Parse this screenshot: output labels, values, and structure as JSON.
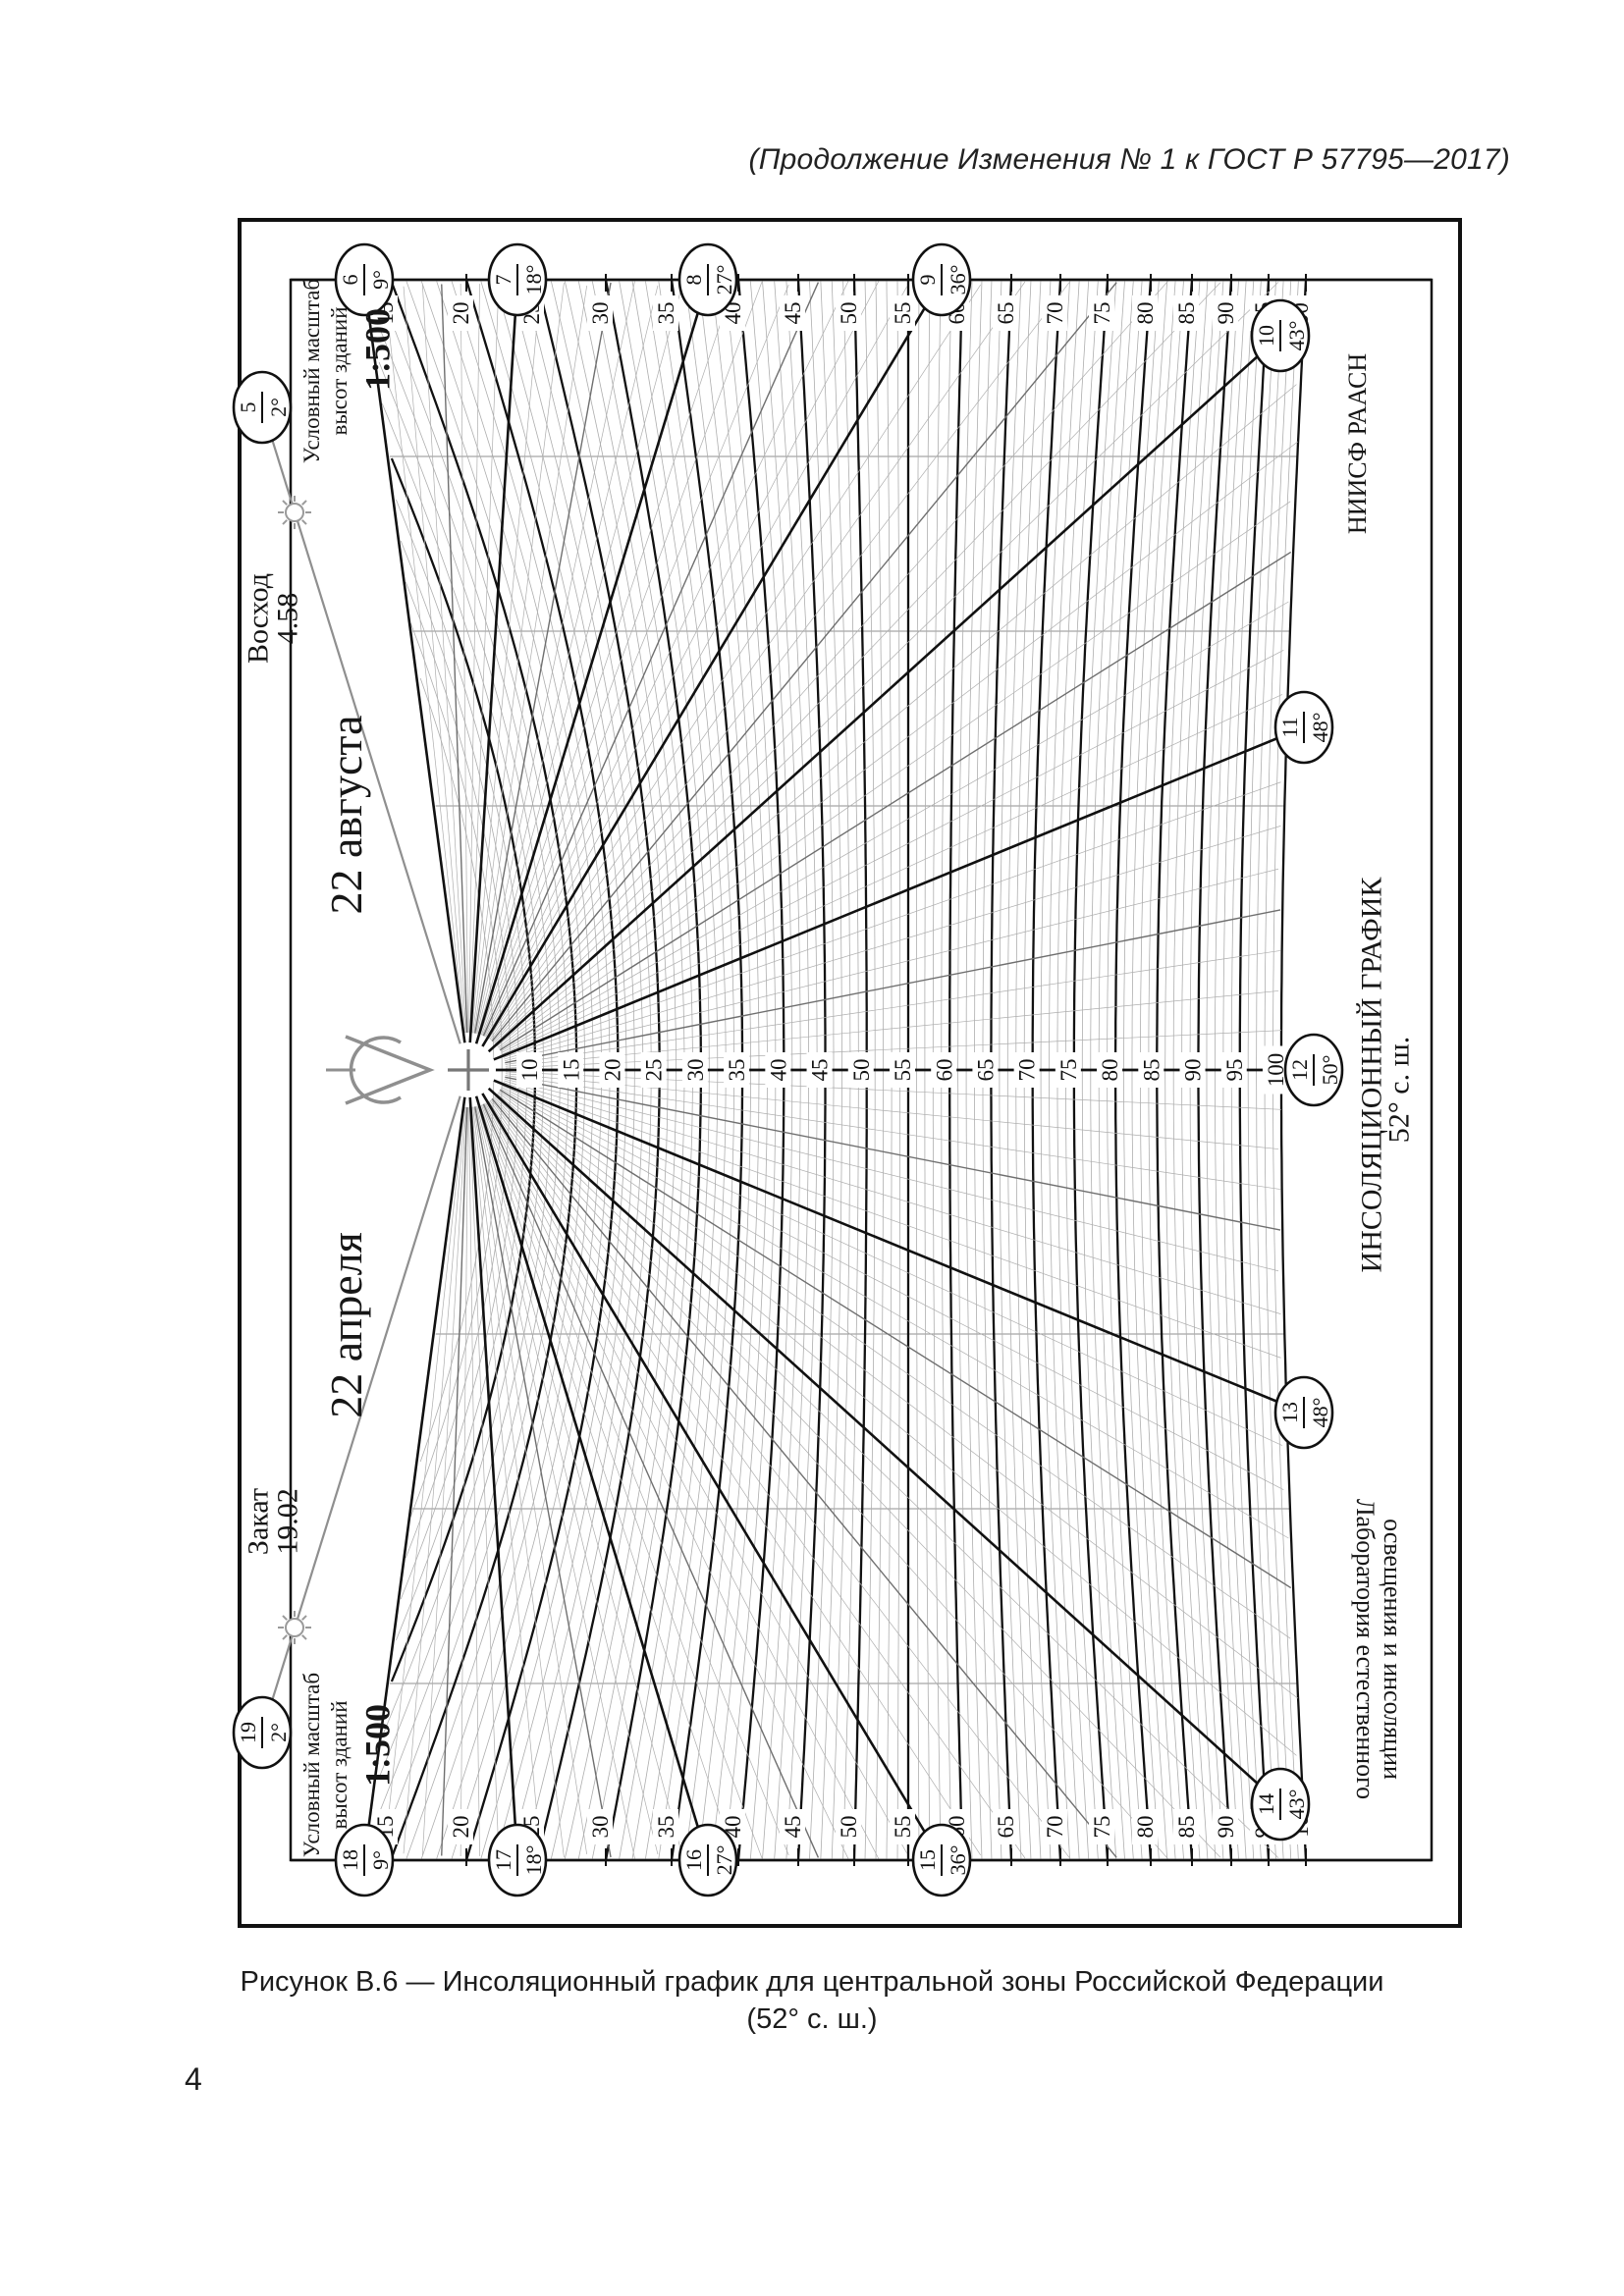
{
  "page": {
    "header": "(Продолжение Изменения № 1 к ГОСТ Р 57795—2017)",
    "number": "4"
  },
  "caption": {
    "line1": "Рисунок В.6 — Инсоляционный график для центральной зоны Российской Федерации",
    "line2": "(52° с. ш.)"
  },
  "chart_data": {
    "type": "diagram",
    "title": "ИНСОЛЯЦИОННЫЙ ГРАФИК",
    "latitude_label": "52° с. ш.",
    "organization": "НИИСФ РААСН",
    "laboratory": [
      "Лаборатория естественного",
      "освещения и инсоляции"
    ],
    "sunrise": {
      "label": "Восход",
      "time": "4.58"
    },
    "sunset": {
      "label": "Закат",
      "time": "19.02"
    },
    "date_august": "22 августа",
    "date_april": "22 апреля",
    "scale_note": {
      "line1": "Условный масштаб",
      "line2": "высот зданий",
      "ratio": "1:500"
    },
    "hours": [
      {
        "hour": "5",
        "altitude": "2°",
        "azimuth": 109.0
      },
      {
        "hour": "6",
        "altitude": "9°",
        "azimuth": 97.5
      },
      {
        "hour": "7",
        "altitude": "18°",
        "azimuth": 86.4
      },
      {
        "hour": "8",
        "altitude": "27°",
        "azimuth": 73.1
      },
      {
        "hour": "9",
        "altitude": "36°",
        "azimuth": 59.0
      },
      {
        "hour": "10",
        "altitude": "43°",
        "azimuth": 42.1
      },
      {
        "hour": "11",
        "altitude": "48°",
        "azimuth": 22.3
      },
      {
        "hour": "12",
        "altitude": "50°",
        "azimuth": 0.0
      },
      {
        "hour": "13",
        "altitude": "48°",
        "azimuth": -22.3
      },
      {
        "hour": "14",
        "altitude": "43°",
        "azimuth": -42.1
      },
      {
        "hour": "15",
        "altitude": "36°",
        "azimuth": -59.0
      },
      {
        "hour": "16",
        "altitude": "27°",
        "azimuth": -73.1
      },
      {
        "hour": "17",
        "altitude": "18°",
        "azimuth": -86.4
      },
      {
        "hour": "18",
        "altitude": "9°",
        "azimuth": -97.5
      },
      {
        "hour": "19",
        "altitude": "2°",
        "azimuth": -109.0
      }
    ],
    "center_scale": [
      10,
      15,
      20,
      25,
      30,
      35,
      40,
      45,
      50,
      55,
      60,
      65,
      70,
      75,
      80,
      85,
      90,
      95,
      100
    ],
    "edge_scale": [
      15,
      20,
      25,
      30,
      35,
      40,
      45,
      50,
      55,
      60,
      65,
      70,
      75,
      80,
      85,
      90,
      95,
      100
    ],
    "colors": {
      "ink": "#111111",
      "gray_line": "#8f8f8f",
      "mesh": "#aeaeae",
      "half_hour": "#6f6f6f"
    }
  }
}
